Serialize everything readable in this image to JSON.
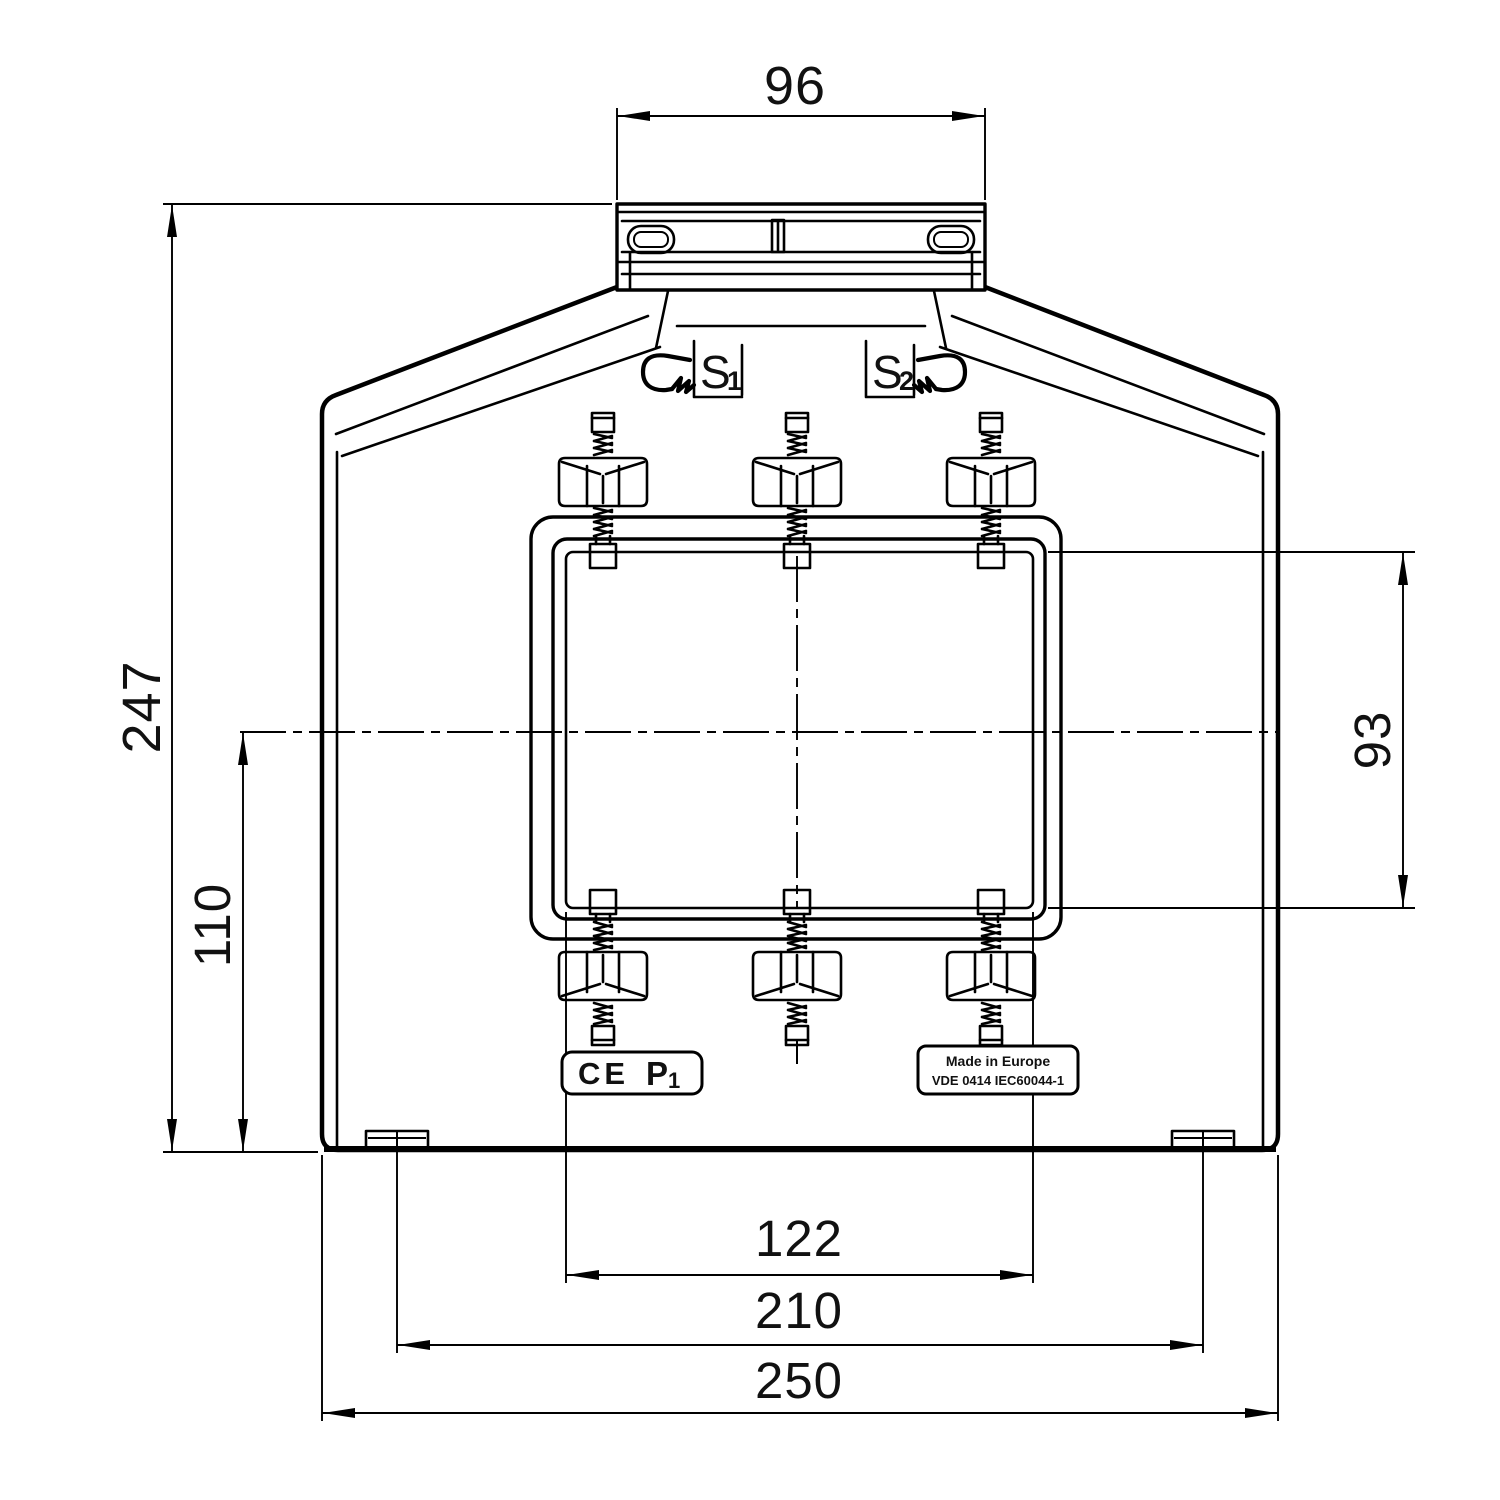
{
  "page": {
    "background": "#ffffff",
    "ink": "#000000"
  },
  "dimensions": {
    "top_terminal_width": {
      "value": "96"
    },
    "overall_height": {
      "value": "247"
    },
    "center_height": {
      "value": "110"
    },
    "window_height": {
      "value": "93"
    },
    "window_width": {
      "value": "122"
    },
    "foot_spacing": {
      "value": "210"
    },
    "overall_width": {
      "value": "250"
    }
  },
  "markings": {
    "s1": {
      "letter": "S",
      "sub": "1"
    },
    "s2": {
      "letter": "S",
      "sub": "2"
    },
    "ce_label": {
      "ce": "CE",
      "terminal": "P",
      "terminal_sub": "1"
    },
    "origin_label": {
      "line1": "Made in Europe",
      "line2": "VDE 0414 IEC60044-1"
    }
  }
}
